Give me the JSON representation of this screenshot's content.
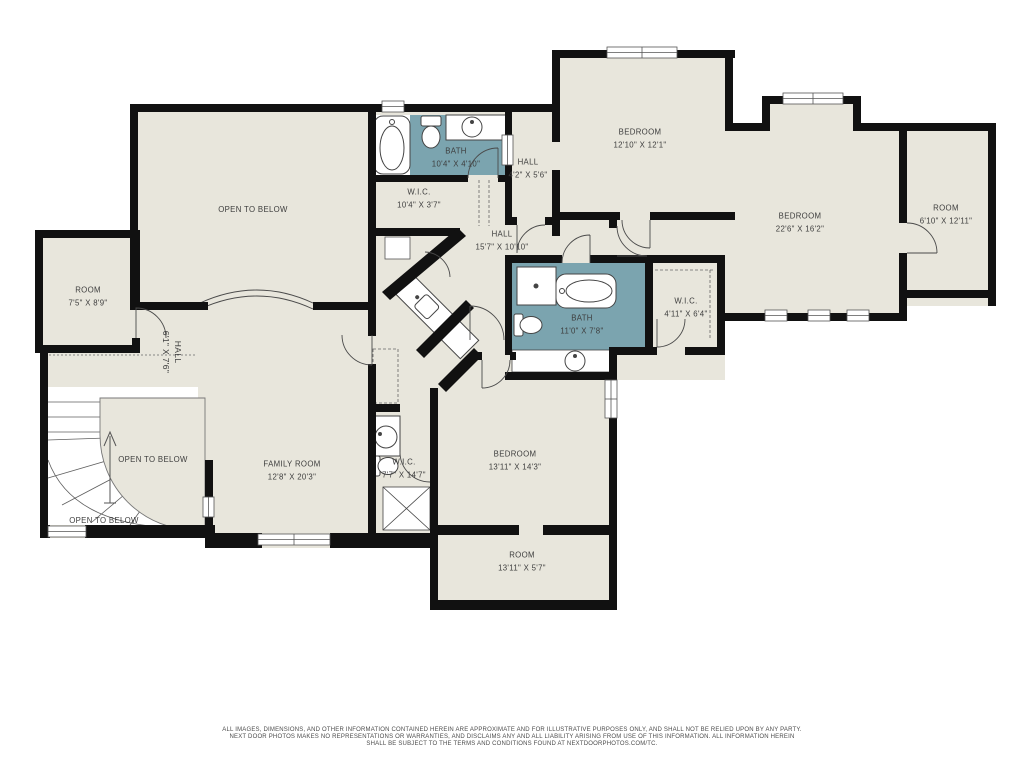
{
  "floorplan": {
    "colors": {
      "floor": "#e8e6dc",
      "bath": "#7ba4af",
      "wall": "#111111",
      "label": "#3d3d3d"
    },
    "rooms": [
      {
        "name": "OPEN TO BELOW",
        "dims": ""
      },
      {
        "name": "BATH",
        "dims": "10'4\" X 4'10\""
      },
      {
        "name": "W.I.C.",
        "dims": "10'4\" X 3'7\""
      },
      {
        "name": "HALL",
        "dims": "4'2\" X 5'6\""
      },
      {
        "name": "BEDROOM",
        "dims": "12'10\" X 12'1\""
      },
      {
        "name": "BEDROOM",
        "dims": "22'6\" X 16'2\""
      },
      {
        "name": "ROOM",
        "dims": "6'10\" X 12'11\""
      },
      {
        "name": "HALL",
        "dims": "15'7\" X 10'10\""
      },
      {
        "name": "ROOM",
        "dims": "7'5\" X 8'9\""
      },
      {
        "name": "HALL",
        "dims": "6'1\" X 7'6\""
      },
      {
        "name": "BATH",
        "dims": "11'0\" X 7'8\""
      },
      {
        "name": "W.I.C.",
        "dims": "4'11\" X 6'4\""
      },
      {
        "name": "FAMILY ROOM",
        "dims": "12'8\" X 20'3\""
      },
      {
        "name": "OPEN TO BELOW",
        "dims": ""
      },
      {
        "name": "OPEN TO BELOW",
        "dims": ""
      },
      {
        "name": "BEDROOM",
        "dims": "13'11\" X 14'3\""
      },
      {
        "name": "W.I.C.",
        "dims": "7'7\" X 14'7\""
      },
      {
        "name": "ROOM",
        "dims": "13'11\" X 5'7\""
      }
    ],
    "disclaimer": {
      "line1": "ALL IMAGES, DIMENSIONS, AND OTHER INFORMATION CONTAINED HEREIN ARE APPROXIMATE AND FOR ILLUSTRATIVE PURPOSES ONLY, AND SHALL NOT BE RELIED UPON BY ANY PARTY.",
      "line2": "NEXT DOOR PHOTOS MAKES NO REPRESENTATIONS OR WARRANTIES, AND DISCLAIMS ANY AND ALL LIABILITY ARISING FROM USE OF THIS INFORMATION. ALL INFORMATION HEREIN",
      "line3": "SHALL BE SUBJECT TO THE TERMS AND CONDITIONS FOUND AT NEXTDOORPHOTOS.COM/TC."
    }
  }
}
